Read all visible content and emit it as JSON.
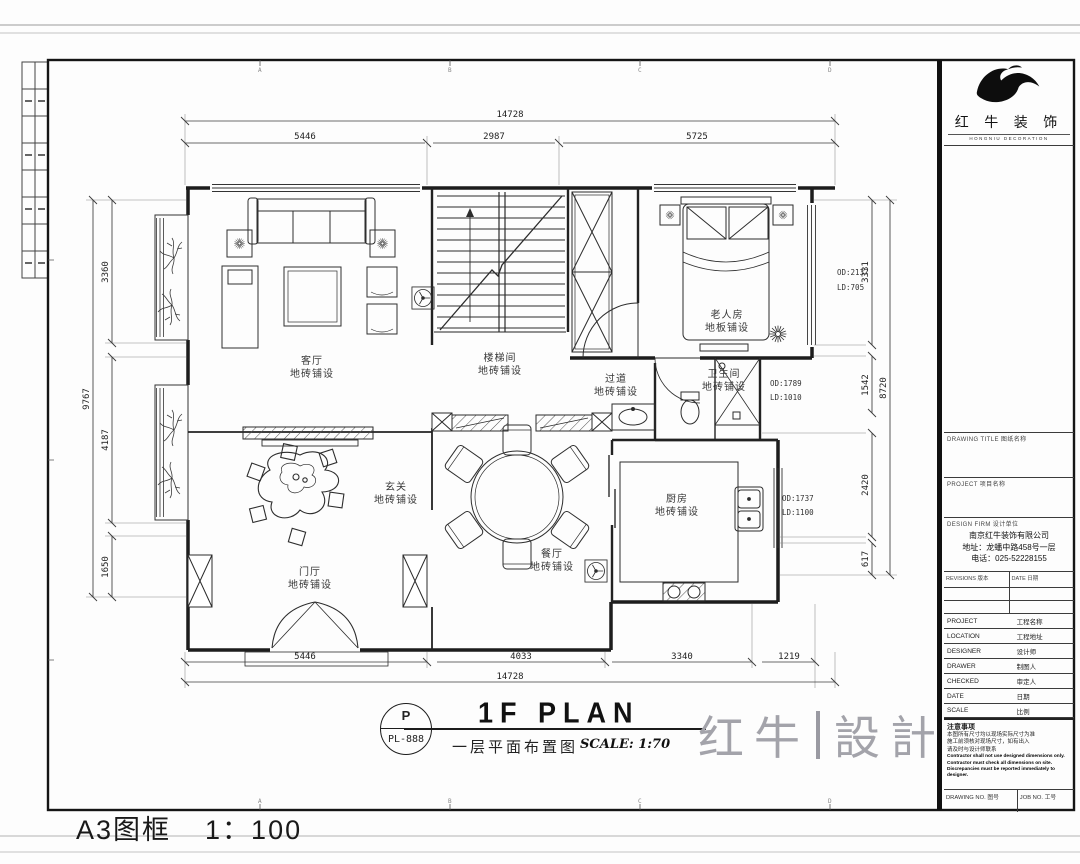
{
  "sheet": {
    "format_label": "A3图框",
    "format_scale": "1：100",
    "grid_letters": [
      "A",
      "B",
      "C",
      "D"
    ]
  },
  "title_bar": {
    "bubble_top": "P",
    "bubble_bottom": "PL-888",
    "title": "1F PLAN",
    "subtitle": "一层平面布置图",
    "scale": "SCALE: 1:70"
  },
  "watermark": {
    "left": "红牛",
    "right": "設計"
  },
  "brand": {
    "logo_icon": "bull-swoosh",
    "name": "红 牛 装 饰",
    "caption": "HONGNIU DECORATION"
  },
  "title_block": {
    "drawing_title_header": "DRAWING TITLE 图纸名称",
    "project_header": "PROJECT 项目名称",
    "firm_header": "DESIGN FIRM 设计单位",
    "firm_lines": [
      "南京红牛装饰有限公司",
      "地址：龙蟠中路458号一层",
      "电话：025-52228155"
    ],
    "rev_headers": [
      "REVISIONS 版本",
      "DATE 日期"
    ],
    "info_rows": [
      {
        "label": "PROJECT",
        "cn": "工程名称"
      },
      {
        "label": "LOCATION",
        "cn": "工程地址"
      },
      {
        "label": "DESIGNER",
        "cn": "设计师"
      },
      {
        "label": "DRAWER",
        "cn": "制图人"
      },
      {
        "label": "CHECKED",
        "cn": "审定人"
      },
      {
        "label": "DATE",
        "cn": "日期"
      },
      {
        "label": "SCALE",
        "cn": "比例"
      }
    ],
    "notes_title": "注意事项",
    "notes_cn": [
      "本图所有尺寸均以现场实际尺寸为准",
      "施工前须核对现场尺寸，如有出入",
      "请及时与设计师联系"
    ],
    "notes_en": [
      "Contractor shall not use designed dimensions only.",
      "Contractor must check all dimensions on site.",
      "Discrepancies must be reported immediately to designer."
    ],
    "drawing_no_label": "DRAWING NO. 图号",
    "job_no_label": "JOB NO. 工号"
  },
  "plan": {
    "rooms": [
      {
        "name": "客厅",
        "finish": "地砖铺设"
      },
      {
        "name": "楼梯间",
        "finish": "地砖铺设"
      },
      {
        "name": "老人房",
        "finish": "地板铺设"
      },
      {
        "name": "过道",
        "finish": "地砖铺设"
      },
      {
        "name": "卫生间",
        "finish": "地砖铺设"
      },
      {
        "name": "玄关",
        "finish": "地砖铺设"
      },
      {
        "name": "门厅",
        "finish": "地砖铺设"
      },
      {
        "name": "餐厅",
        "finish": "地砖铺设"
      },
      {
        "name": "厨房",
        "finish": "地砖铺设"
      }
    ],
    "dims": {
      "top": {
        "total": "14728",
        "segments": [
          "5446",
          "2987",
          "5725"
        ]
      },
      "bottom": {
        "total": "14728",
        "segments": [
          "5446",
          "4033",
          "3340",
          "1219"
        ]
      },
      "left": {
        "total": "9767",
        "segments": [
          "3360",
          "4187",
          "1650"
        ]
      },
      "right": {
        "total": "8720",
        "segments": [
          "3331",
          "1542",
          "2420",
          "617"
        ]
      }
    },
    "annotations": [
      {
        "l1": "OD:2137",
        "l2": "LD:705"
      },
      {
        "l1": "OD:1789",
        "l2": "LD:1010"
      },
      {
        "l1": "OD:1737",
        "l2": "LD:1100"
      }
    ]
  }
}
